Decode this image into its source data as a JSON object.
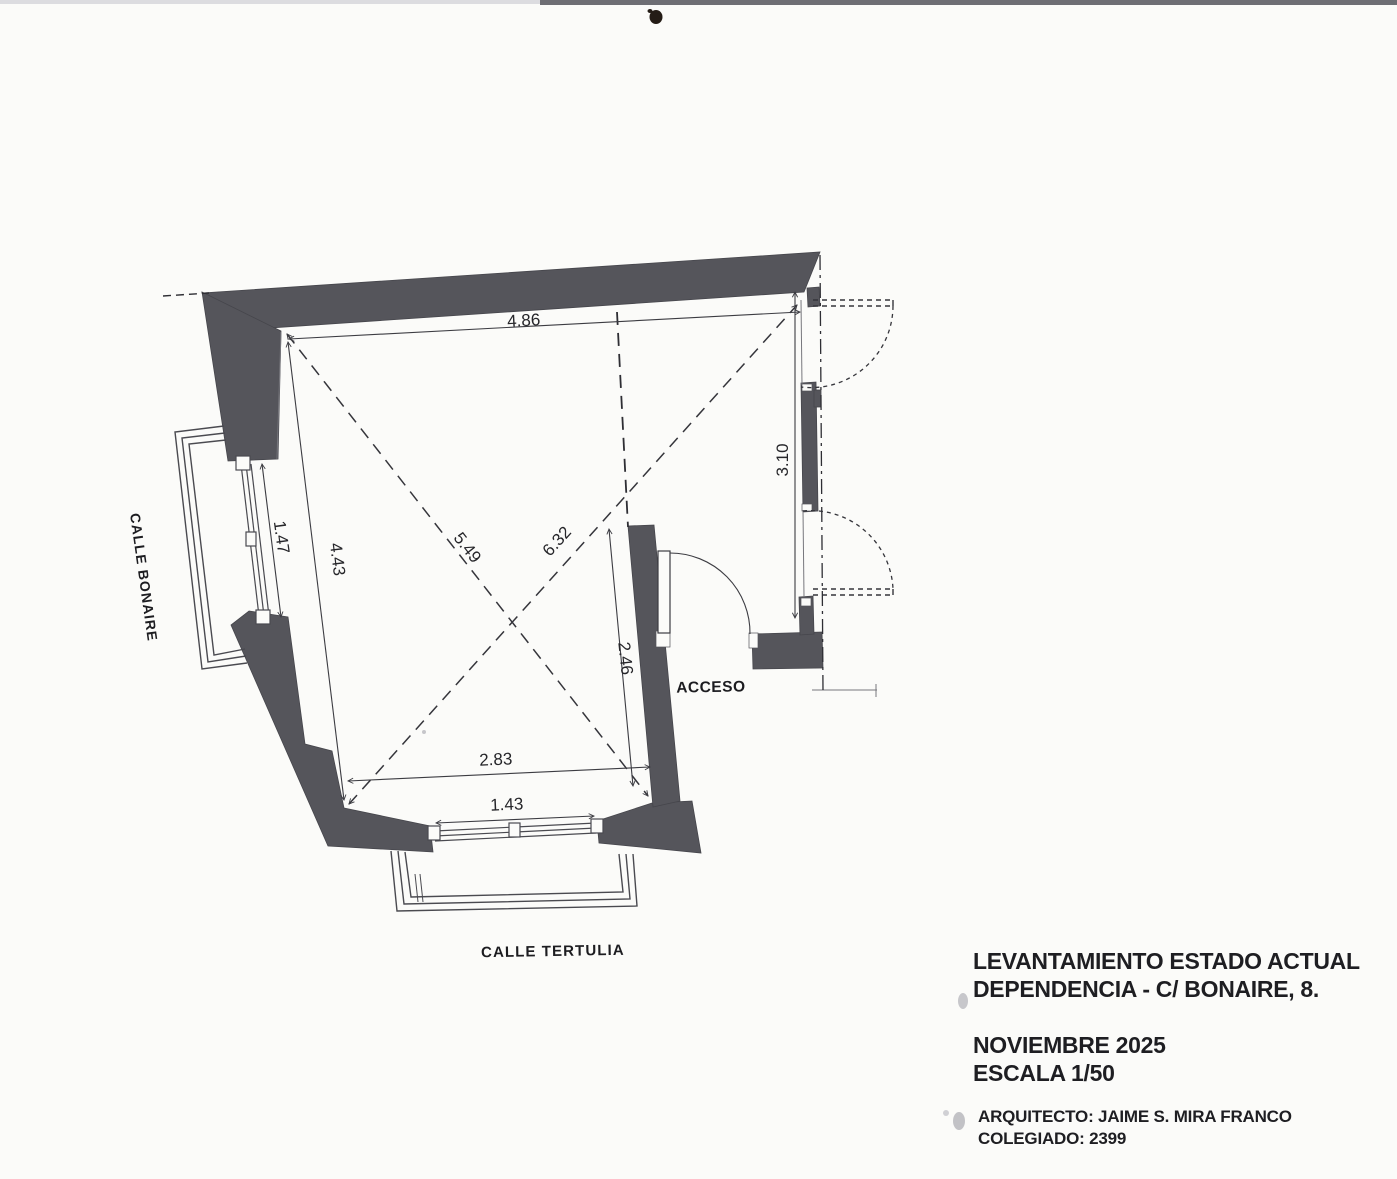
{
  "plan": {
    "dims": {
      "top": "4.86",
      "left_wall": "4.43",
      "left_window": "1.47",
      "diag_short": "5.49",
      "diag_long": "6.32",
      "partition": "2.46",
      "right": "3.10",
      "bottom": "2.83",
      "bottom_window": "1.43"
    },
    "streets": {
      "left": "CALLE BONAIRE",
      "bottom": "CALLE TERTULIA"
    },
    "access": "ACCESO"
  },
  "title_block": {
    "line1": "LEVANTAMIENTO ESTADO ACTUAL",
    "line2": "DEPENDENCIA - C/ BONAIRE, 8.",
    "date": "NOVIEMBRE 2025",
    "scale": "ESCALA 1/50",
    "architect": "ARQUITECTO: JAIME S. MIRA FRANCO",
    "license": "COLEGIADO: 2399"
  },
  "colors": {
    "wall_fill": "#55555b",
    "line": "#3c3c42",
    "text": "#1e1e22",
    "paper": "#fbfbf9"
  }
}
